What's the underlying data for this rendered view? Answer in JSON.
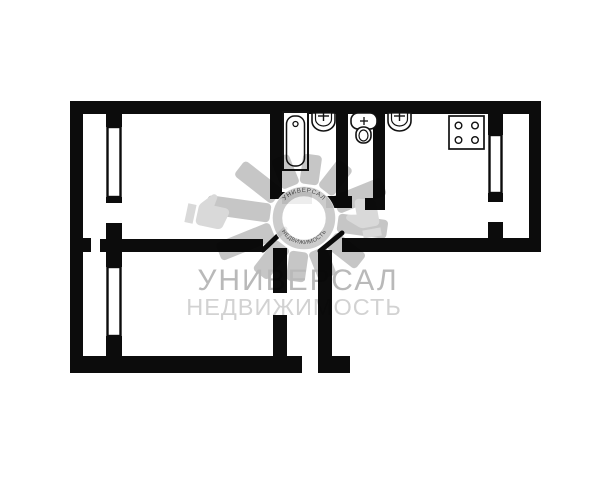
{
  "watermark": {
    "brand": "УНИВЕРСАЛ",
    "tagline": "НЕДВИЖИМОСТЬ",
    "ring_top": "УНИВЕРСАЛ",
    "ring_bottom": "НЕДВИЖИМОСТЬ",
    "colors": {
      "brand_text": "#b9b9b9",
      "tagline_text": "#d2d2d2",
      "rays": "#c6c6c6",
      "hands": "#d9d9d9",
      "ring": "#c9c9c9",
      "ring_text": "#383838"
    }
  },
  "floor_plan": {
    "background": "#ffffff",
    "wall_color": "#0c0c0c",
    "rooms": [
      "living-room",
      "bedroom",
      "bathroom",
      "wc",
      "kitchen",
      "hallway",
      "entry-corridor",
      "balcony-left",
      "balcony-right"
    ],
    "fixtures": [
      {
        "name": "bathtub"
      },
      {
        "name": "bathroom-sink"
      },
      {
        "name": "toilet"
      },
      {
        "name": "kitchen-sink"
      },
      {
        "name": "stove-4-burner"
      }
    ],
    "windows": [
      "living-room-window",
      "bedroom-window",
      "kitchen-window"
    ],
    "doors": [
      "living-room-door",
      "hall-door",
      "bedroom-door",
      "bathroom-door",
      "wc-door",
      "entrance-door",
      "balcony-door-left",
      "balcony-door-right"
    ]
  }
}
